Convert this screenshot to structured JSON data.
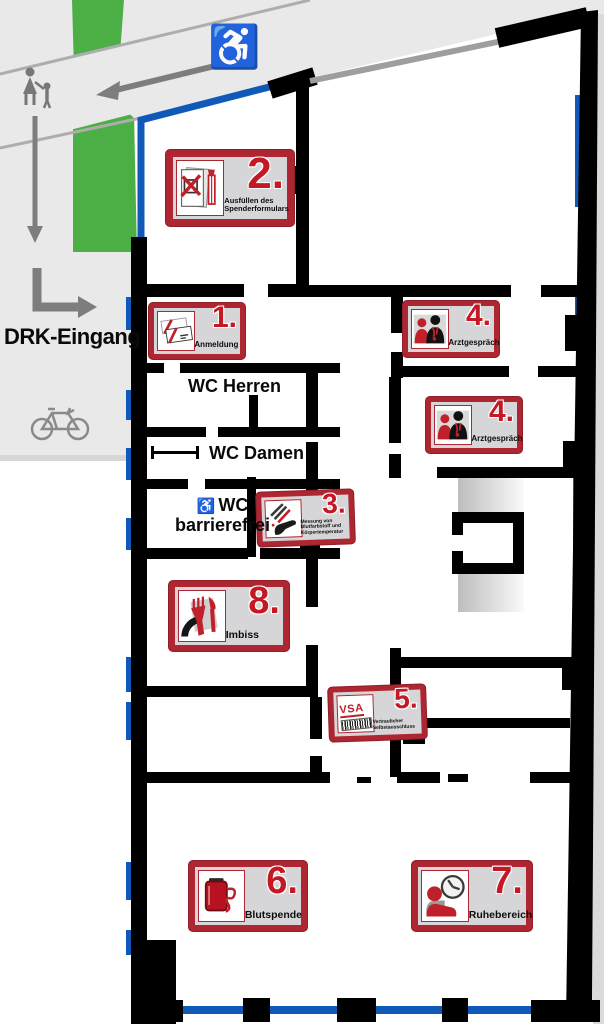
{
  "colors": {
    "sign_frame_red": "#ae2631",
    "number_red": "#c41824",
    "window_blue": "#1059b8",
    "lawn_green": "#4caf46",
    "wall_black": "#000000",
    "ground_gray": "#e9e9e9"
  },
  "outside": {
    "entrance_label": "DRK-Eingang"
  },
  "icons": {
    "wheelchair_char": "♿"
  },
  "rooms": {
    "wc_men_label": "WC Herren",
    "wc_women_label": "WC Damen",
    "wc_accessible_line1": "WC",
    "wc_accessible_line2": "barrierefrei"
  },
  "signs": [
    {
      "number": "1.",
      "label": "Anmeldung"
    },
    {
      "number": "2.",
      "label": "Ausfüllen des Spenderformulars"
    },
    {
      "number": "3.",
      "label": "Messung von Blutfarbstoff und Körpertemperatur"
    },
    {
      "number": "4.",
      "label": "Arztgespräch"
    },
    {
      "number": "5.",
      "label": "Vertraulicher Selbstausschluss",
      "icon_text": "VSA"
    },
    {
      "number": "6.",
      "label": "Blutspende"
    },
    {
      "number": "7.",
      "label": "Ruhebereich"
    },
    {
      "number": "8.",
      "label": "Imbiss"
    }
  ]
}
